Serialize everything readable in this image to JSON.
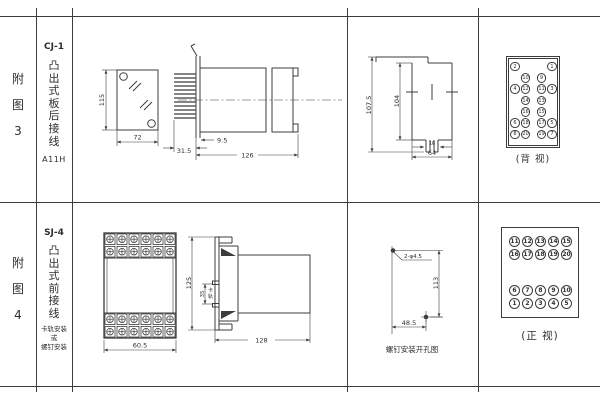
{
  "colors": {
    "line": "#3c3c3c",
    "text": "#2e2e2e",
    "background": "#ffffff"
  },
  "figure3": {
    "index_chars": [
      "附",
      "图",
      "3"
    ],
    "model": "CJ-1",
    "type_chars": [
      "凸",
      "出",
      "式",
      "板",
      "后",
      "接",
      "线"
    ],
    "code": "A11H",
    "front_view": {
      "height": "115",
      "width": "72"
    },
    "side_view": {
      "pin_depth": "31.5",
      "flange_offset": "9.5",
      "total_length": "126"
    },
    "panel_cutout": {
      "overall_height": "107.5",
      "inner_height": "104",
      "slot_width": "16",
      "width": "64"
    },
    "terminal_view": {
      "caption": "(背 视)",
      "cells": [
        "2",
        "",
        "",
        "",
        "1",
        "",
        "10",
        "",
        "9",
        "",
        "4",
        "12",
        "",
        "11",
        "3",
        "",
        "14",
        "",
        "13",
        "",
        "",
        "16",
        "",
        "15",
        "",
        "6",
        "18",
        "",
        "17",
        "5",
        "8",
        "20",
        "",
        "19",
        "7"
      ]
    }
  },
  "figure4": {
    "index_chars": [
      "附",
      "图",
      "4"
    ],
    "model": "SJ-4",
    "type_chars": [
      "凸",
      "出",
      "式",
      "前",
      "接",
      "线"
    ],
    "mount_note": [
      "卡轨安装",
      "或",
      "螺钉安装"
    ],
    "front_view": {
      "width": "60.5"
    },
    "side_view": {
      "height": "125",
      "rail_height": "35",
      "rail_label_chars": [
        "卡",
        "轨"
      ],
      "depth": "128"
    },
    "drill_view": {
      "holes": "2-φ4.5",
      "vertical": "113",
      "horizontal": "48.5",
      "caption": "螺钉安装开孔图"
    },
    "terminal_view": {
      "caption": "(正 视)",
      "top_cells": [
        "11",
        "12",
        "13",
        "14",
        "15",
        "16",
        "17",
        "18",
        "19",
        "20"
      ],
      "bottom_cells": [
        "6",
        "7",
        "8",
        "9",
        "10",
        "1",
        "2",
        "3",
        "4",
        "5"
      ]
    }
  }
}
